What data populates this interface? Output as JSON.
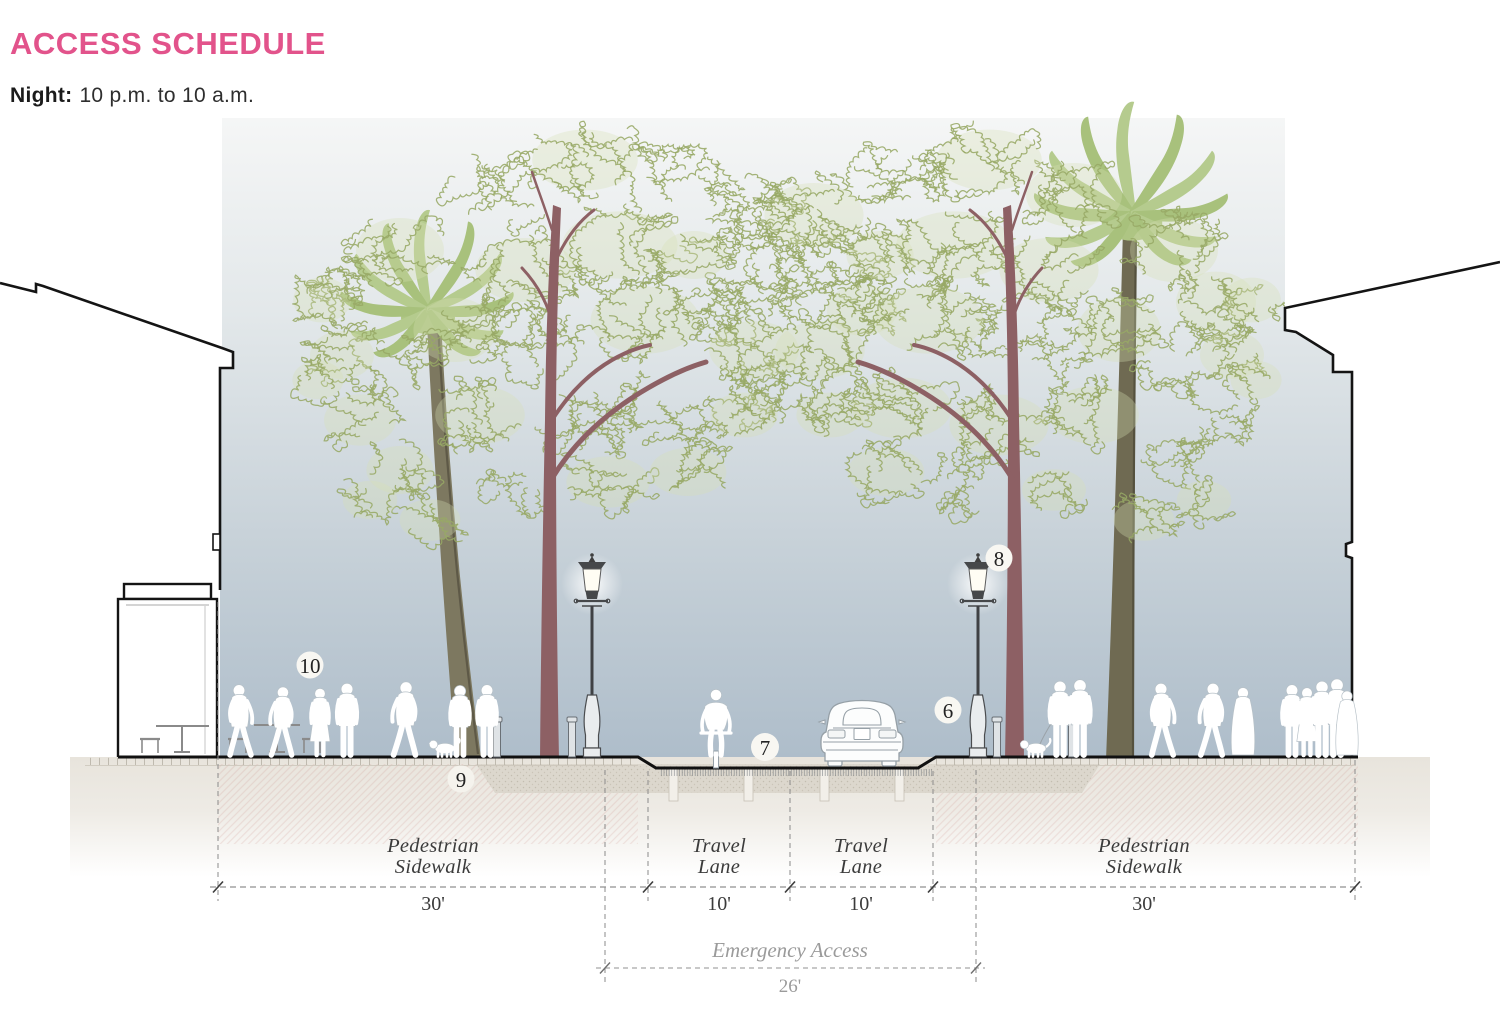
{
  "header": {
    "title": "ACCESS SCHEDULE",
    "period_label": "Night:",
    "period_value": "10 p.m. to 10 a.m."
  },
  "dimensions": {
    "segments": [
      {
        "line1": "Pedestrian",
        "line2": "Sidewalk",
        "width": "30'"
      },
      {
        "line1": "Travel",
        "line2": "Lane",
        "width": "10'"
      },
      {
        "line1": "Travel",
        "line2": "Lane",
        "width": "10'"
      },
      {
        "line1": "Pedestrian",
        "line2": "Sidewalk",
        "width": "30'"
      }
    ],
    "emergency": {
      "label": "Emergency Access",
      "width": "26'"
    }
  },
  "callouts": [
    {
      "number": "6"
    },
    {
      "number": "7"
    },
    {
      "number": "8"
    },
    {
      "number": "9"
    },
    {
      "number": "10"
    }
  ],
  "colors": {
    "accent_pink": "#e2538b",
    "sky_top": "#f5f6f6",
    "sky_bottom": "#aebdca",
    "foliage_stroke": "#97a865",
    "palm_green": "#b5cb8e",
    "street_tree_trunk": "#8d6064",
    "palm_trunk": "#7d7860"
  }
}
